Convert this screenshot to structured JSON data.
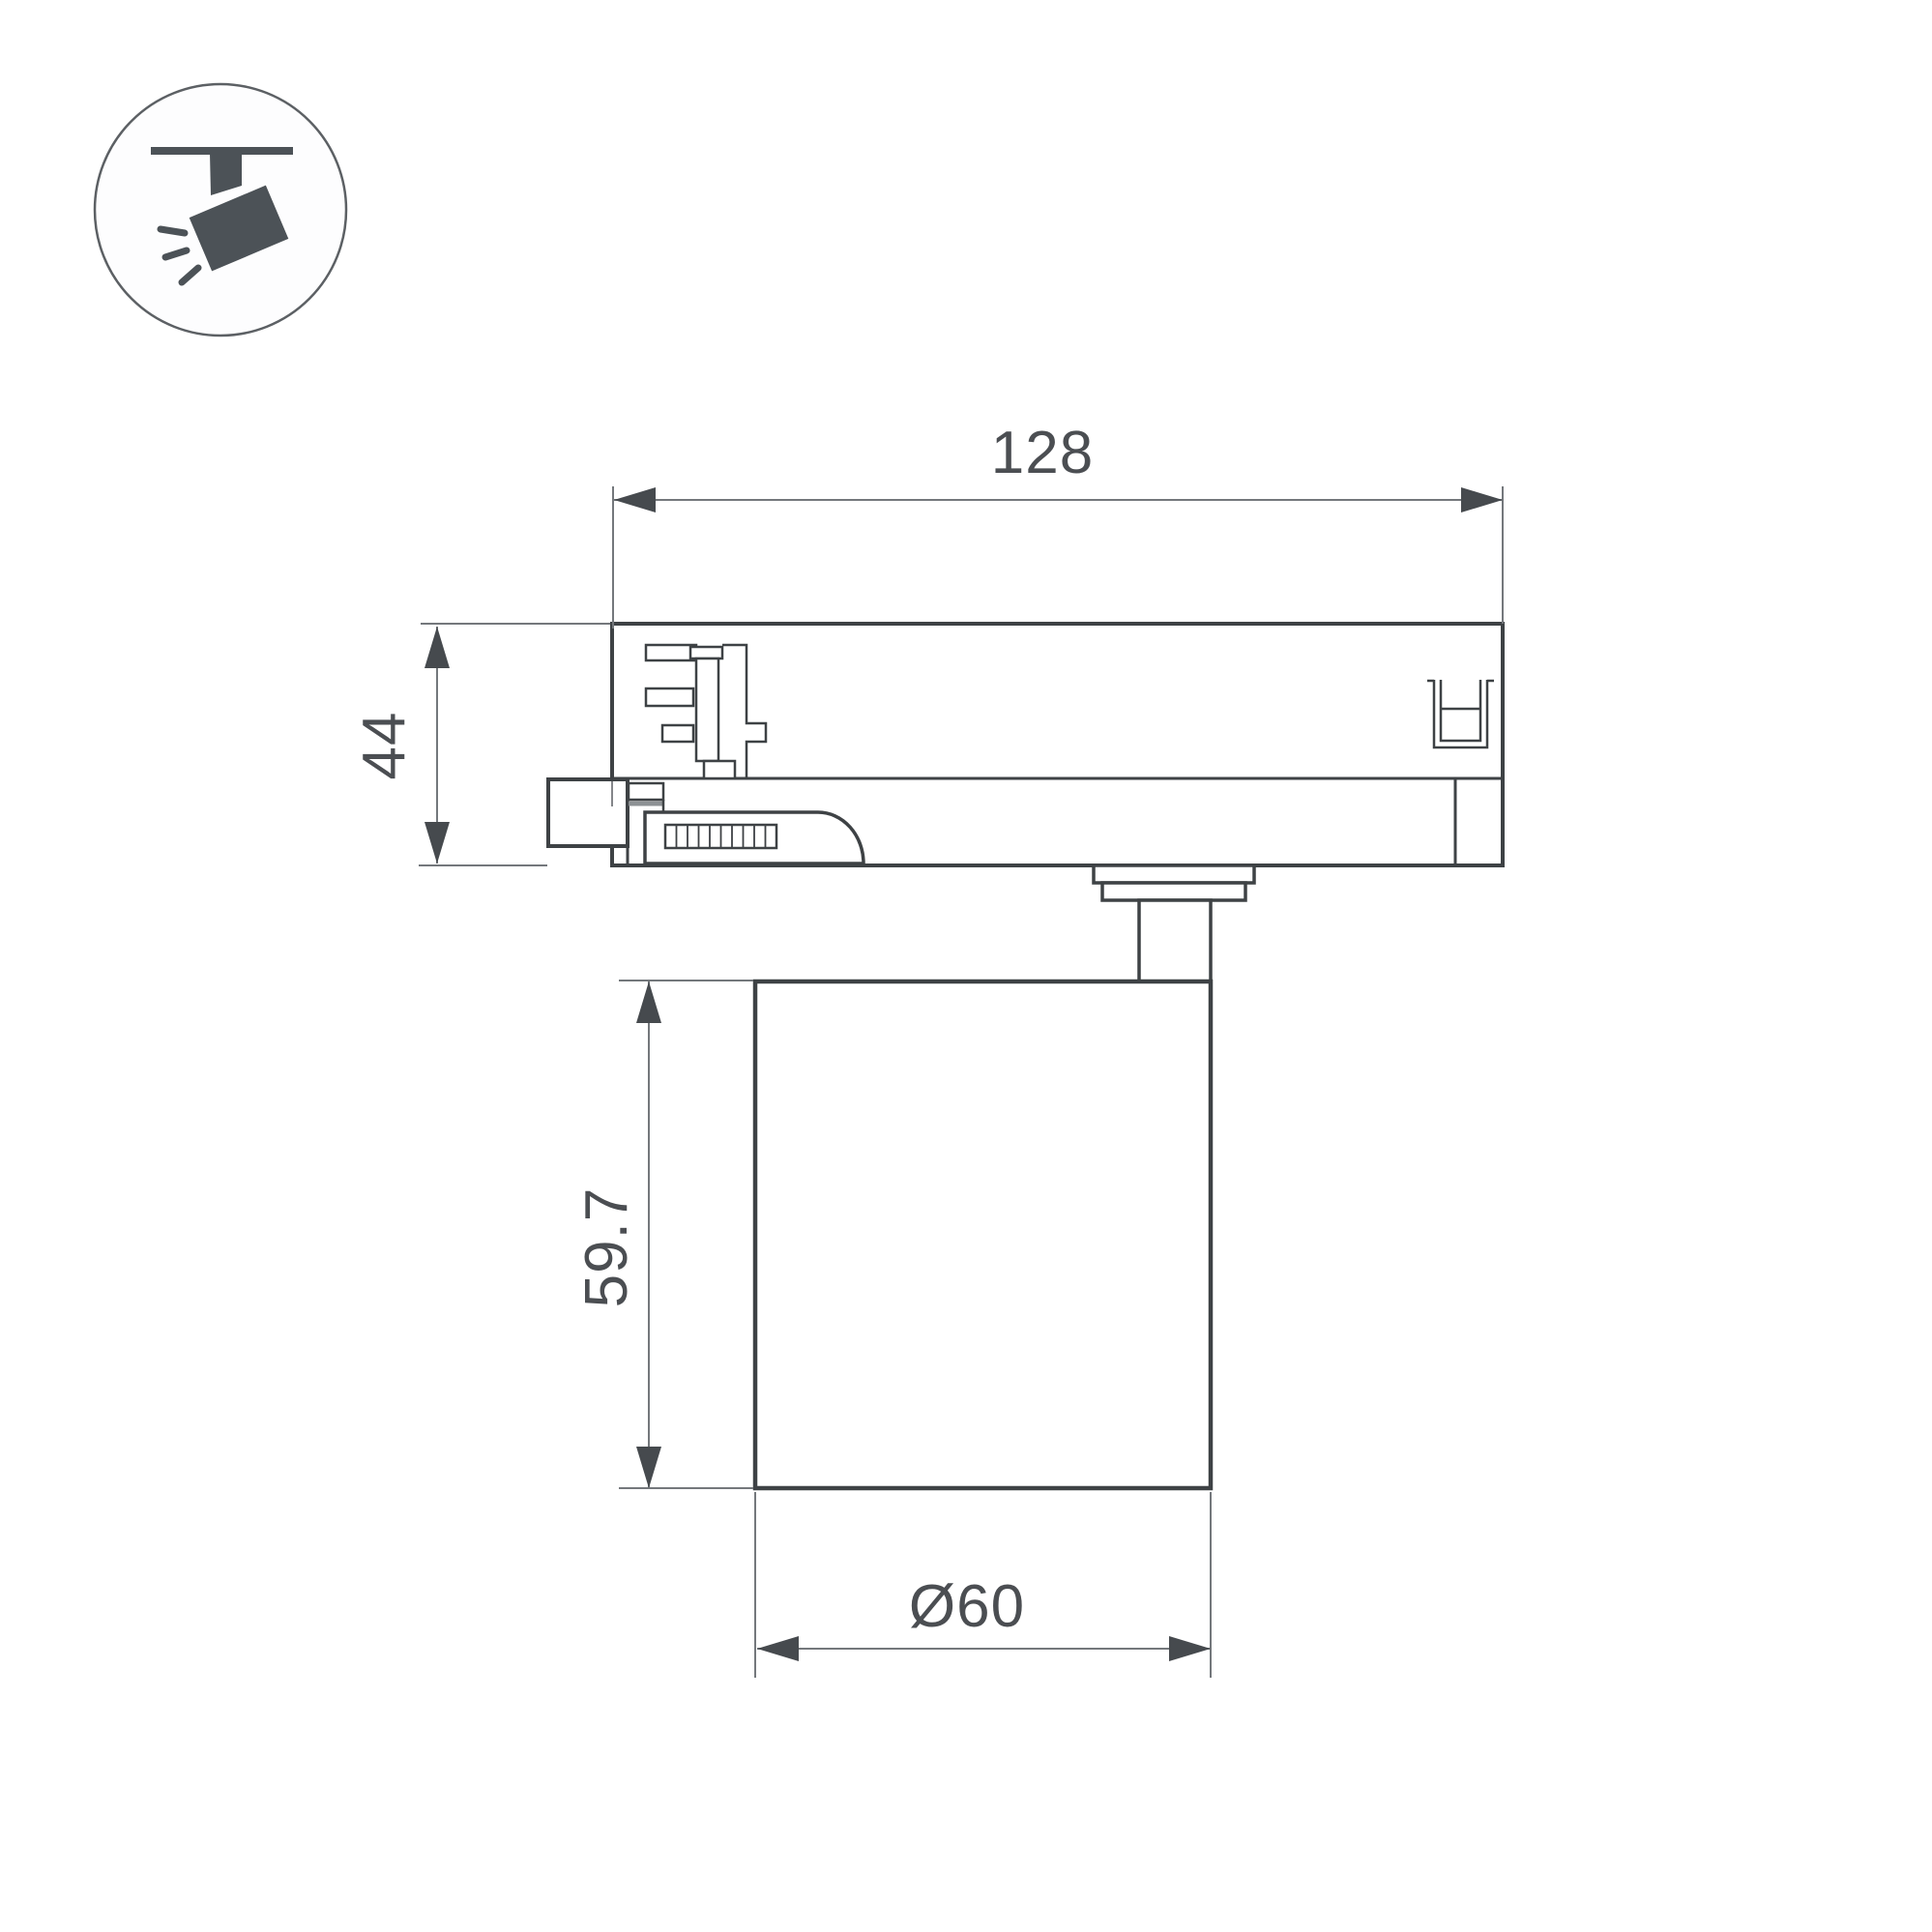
{
  "page": {
    "background": "#ffffff"
  },
  "icon": {
    "name": "track-spotlight-icon",
    "color": "#4c5257",
    "circle_stroke_color": "#5c6064"
  },
  "drawing": {
    "type": "technical-dimension-drawing",
    "subject": "track-mounted spotlight, side elevation with track adapter",
    "outline_color": "#3e4245",
    "dimension_line_color": "#74787c",
    "text_color": "#4b4e52",
    "dimensions": {
      "track_adapter_width": "128",
      "track_adapter_height": "44",
      "lamp_body_height": "59.7",
      "lamp_body_diameter": "Ø60"
    }
  }
}
